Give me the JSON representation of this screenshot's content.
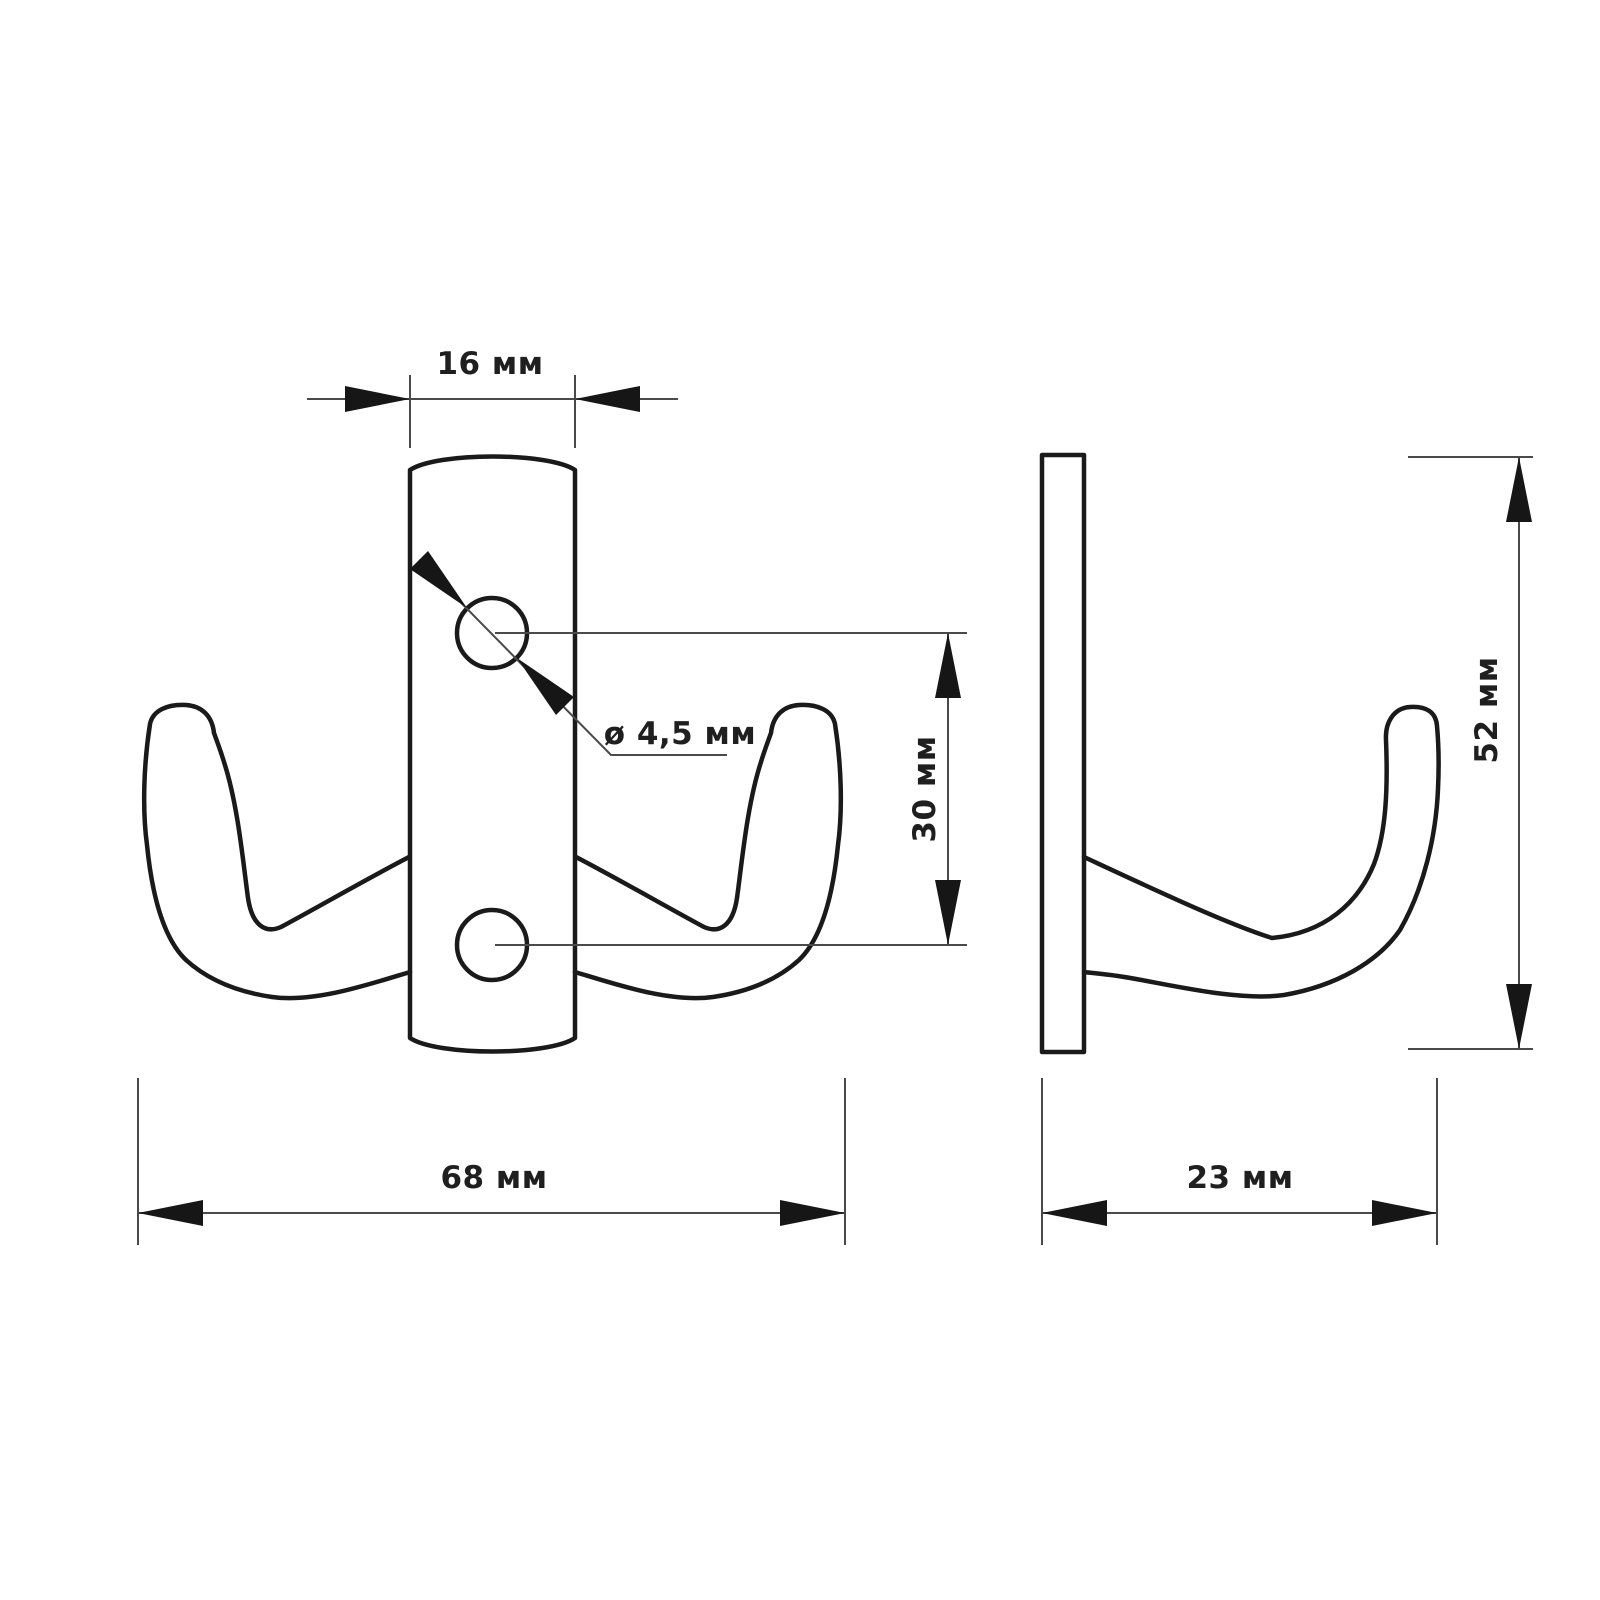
{
  "drawing": {
    "type": "technical-dimension-drawing",
    "subject": "double coat hook, front view and side view",
    "units": "мм",
    "colors": {
      "background": "#ffffff",
      "outline": "#1a1a1a",
      "dimension_lines": "#4a4a4a",
      "text": "#1f1f1f"
    }
  },
  "dimensions": {
    "plate_width": {
      "label": "16 мм",
      "value": 16,
      "applies_to": "front view plate width"
    },
    "hole_diameter": {
      "label": "ø 4,5 мм",
      "value": 4.5,
      "applies_to": "screw hole diameter"
    },
    "hole_spacing": {
      "label": "30 мм",
      "value": 30,
      "applies_to": "distance between hole centers"
    },
    "total_width": {
      "label": "68 мм",
      "value": 68,
      "applies_to": "front view overall width"
    },
    "total_height": {
      "label": "52 мм",
      "value": 52,
      "applies_to": "side view overall height"
    },
    "total_depth": {
      "label": "23 мм",
      "value": 23,
      "applies_to": "side view overall depth"
    }
  }
}
